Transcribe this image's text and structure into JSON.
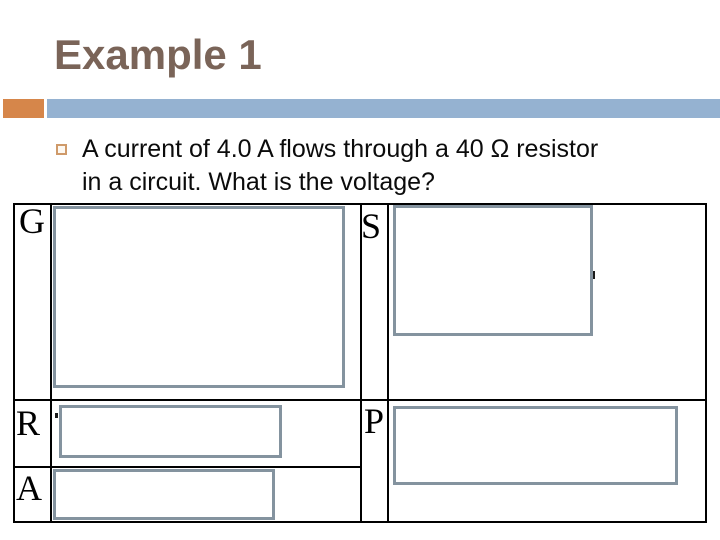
{
  "slide": {
    "title": "Example 1"
  },
  "question": {
    "bullet_icon": "orange-outline-square",
    "lines": [
      "A current of 4.0 A flows through a 40 Ω resistor",
      "in a circuit. What is the voltage?"
    ]
  },
  "grasp_table": {
    "left_labels": [
      "G",
      "R",
      "A"
    ],
    "right_labels": [
      "S",
      "P"
    ],
    "answer_boxes": [
      {
        "name": "given-answer-box",
        "row": "G",
        "content": ""
      },
      {
        "name": "solution-answer-box",
        "row": "S",
        "content": ""
      },
      {
        "name": "required-answer-box",
        "row": "R",
        "content": ""
      },
      {
        "name": "paraphrase-answer-box",
        "row": "P",
        "content": ""
      },
      {
        "name": "analysis-answer-box",
        "row": "A",
        "content": ""
      }
    ]
  },
  "colors": {
    "title_text": "#7a6458",
    "accent_orange": "#d6864a",
    "accent_blue": "#95b2d1",
    "bullet_border": "#cf9a6a",
    "answer_box_border": "#84939f",
    "table_border": "#000000",
    "body_text": "#0b0b0b",
    "background": "#ffffff"
  }
}
